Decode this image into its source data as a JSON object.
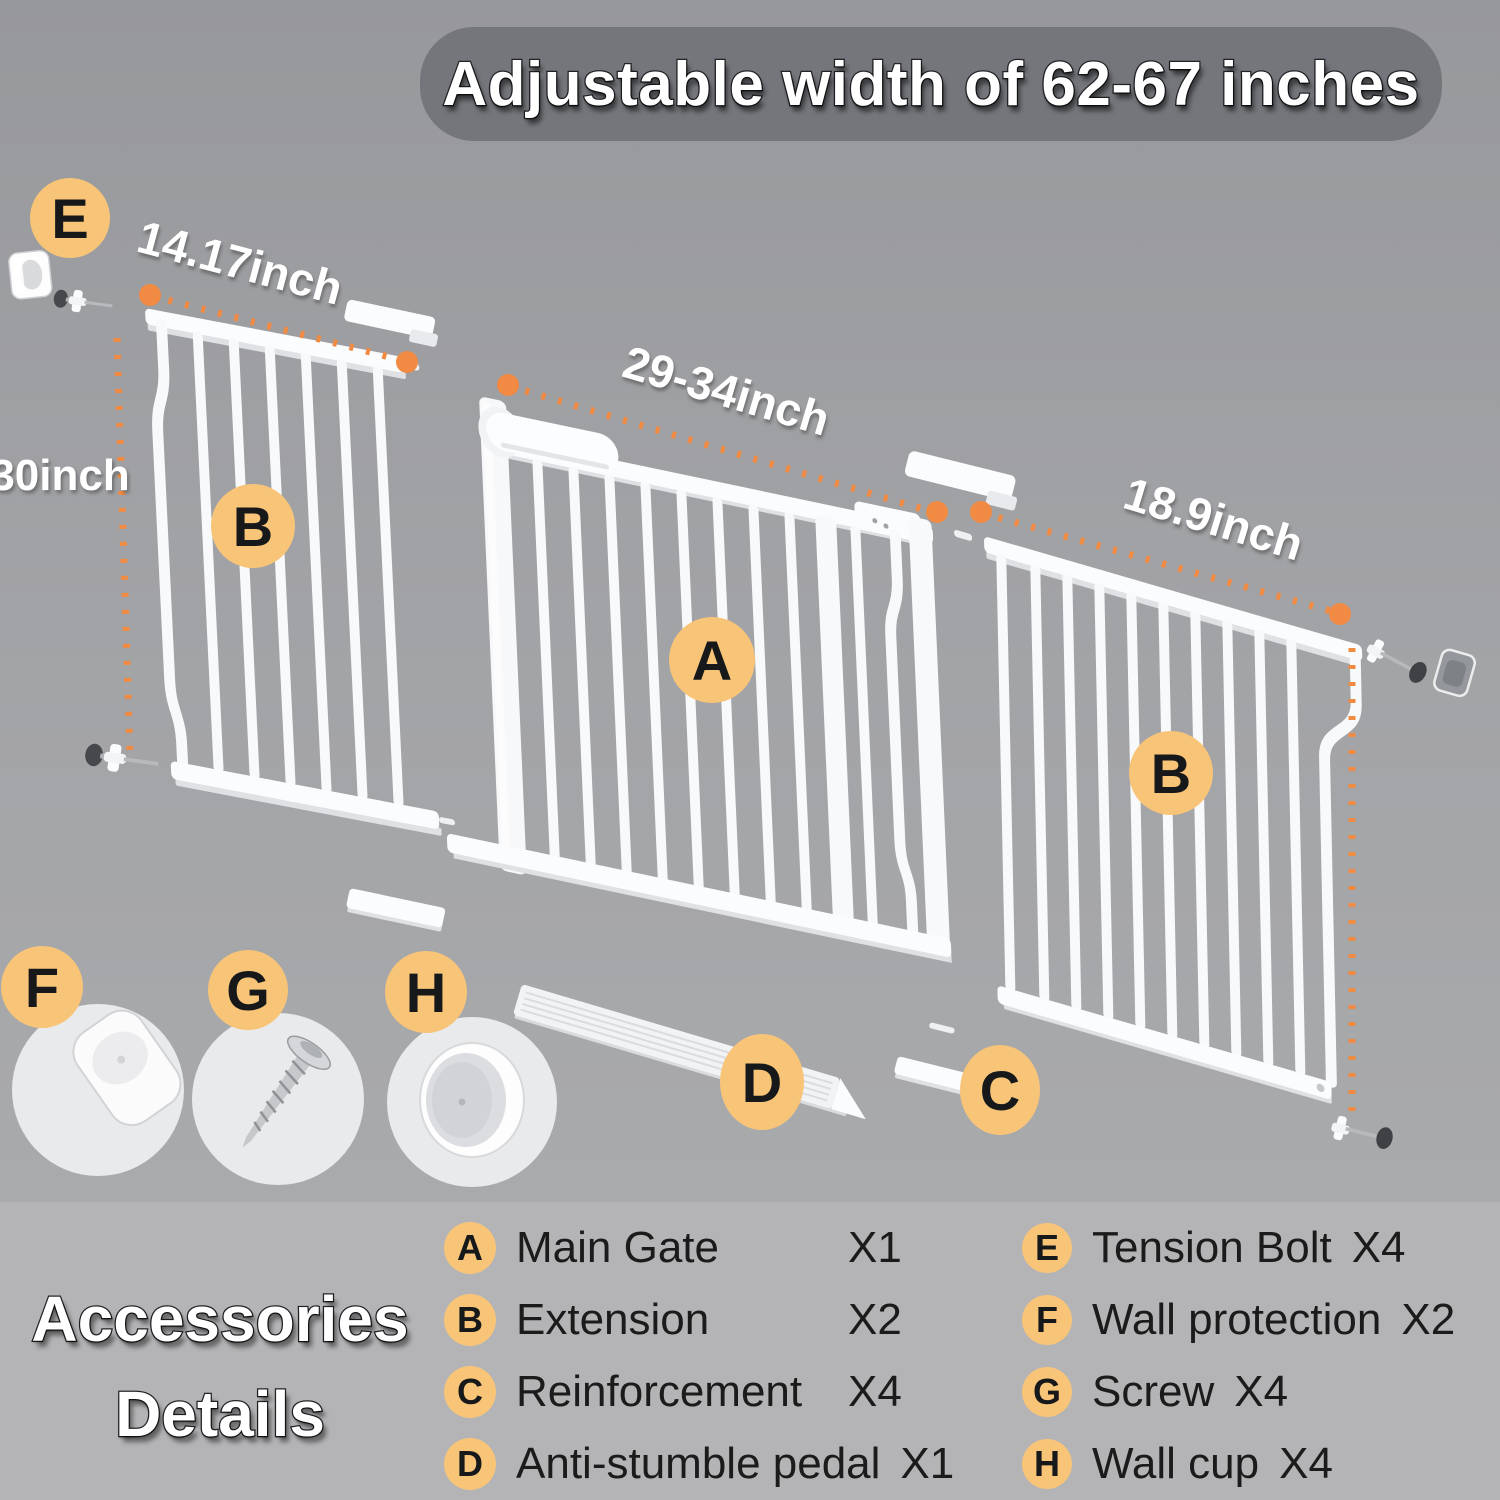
{
  "title": "Adjustable width of 62-67 inches",
  "diagram": {
    "measurements": {
      "left_extension_width": "14.17inch",
      "gate_height": "30inch",
      "main_gate_width": "29-34inch",
      "right_extension_width": "18.9inch"
    },
    "badges": {
      "main_gate": "A",
      "extension_left": "B",
      "extension_right": "B",
      "reinforcement": "C",
      "pedal": "D",
      "tension_bolt": "E",
      "wall_protection": "F",
      "screw": "G",
      "wall_cup": "H"
    }
  },
  "legend": {
    "heading_line1": "Accessories",
    "heading_line2": "Details",
    "items": [
      {
        "letter": "A",
        "label": "Main Gate",
        "qty": "X1"
      },
      {
        "letter": "B",
        "label": "Extension",
        "qty": "X2"
      },
      {
        "letter": "C",
        "label": "Reinforcement",
        "qty": "X4"
      },
      {
        "letter": "D",
        "label": "Anti-stumble pedal",
        "qty": "X1"
      },
      {
        "letter": "E",
        "label": "Tension Bolt",
        "qty": "X4"
      },
      {
        "letter": "F",
        "label": "Wall protection",
        "qty": "X2"
      },
      {
        "letter": "G",
        "label": "Screw",
        "qty": "X4"
      },
      {
        "letter": "H",
        "label": "Wall cup",
        "qty": "X4"
      }
    ]
  },
  "colors": {
    "badge_orange": "#F8C478",
    "dash_orange": "#F18A42",
    "banner_gray": "#74767B",
    "background_gray": "#A1A2A5",
    "legend_panel_gray": "#B4B4B6"
  }
}
